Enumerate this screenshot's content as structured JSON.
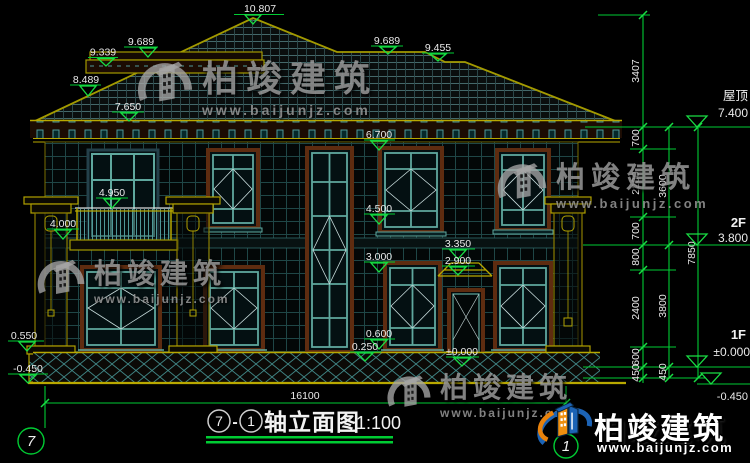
{
  "watermark": {
    "brand": "柏竣建筑",
    "url": "www.baijunjz.com"
  },
  "drawing": {
    "roof_levels": {
      "apex": "10.807",
      "left_upper": "9.689",
      "left_ledge": "9.339",
      "left_slope": "8.489",
      "left_eave": "7.650",
      "right_ridge": "9.689",
      "right_lower_ridge": "9.455"
    },
    "facade_levels": {
      "eave": "6.700",
      "rail": "4.950",
      "balcony": "4.000",
      "sill2": "4.500",
      "head1": "3.000",
      "canopy_top": "3.350",
      "canopy_btm": "2.900",
      "sill1": "0.600",
      "plinth": "0.250",
      "entry": "±0.000"
    },
    "left_levels": {
      "plinth": "0.550",
      "ground": "-0.450"
    },
    "right_dims": {
      "segments": [
        "3407",
        "700",
        "2200",
        "700",
        "800",
        "2400",
        "600",
        "450"
      ],
      "subtotals": [
        "3600",
        "3800",
        "450"
      ],
      "total": "7850"
    },
    "right_levels": {
      "roof_label": "屋顶",
      "roof": "7.400",
      "f2_label": "2F",
      "f2": "3.800",
      "f1_label": "1F",
      "f1": "±0.000",
      "below": "-0.450"
    },
    "bottom": {
      "overall": "16100",
      "axis_left": "7",
      "axis_right": "1"
    },
    "title": {
      "axis_start": "7",
      "separator": "-",
      "axis_end": "1",
      "name": "轴立面图",
      "scale": "1:100"
    }
  }
}
